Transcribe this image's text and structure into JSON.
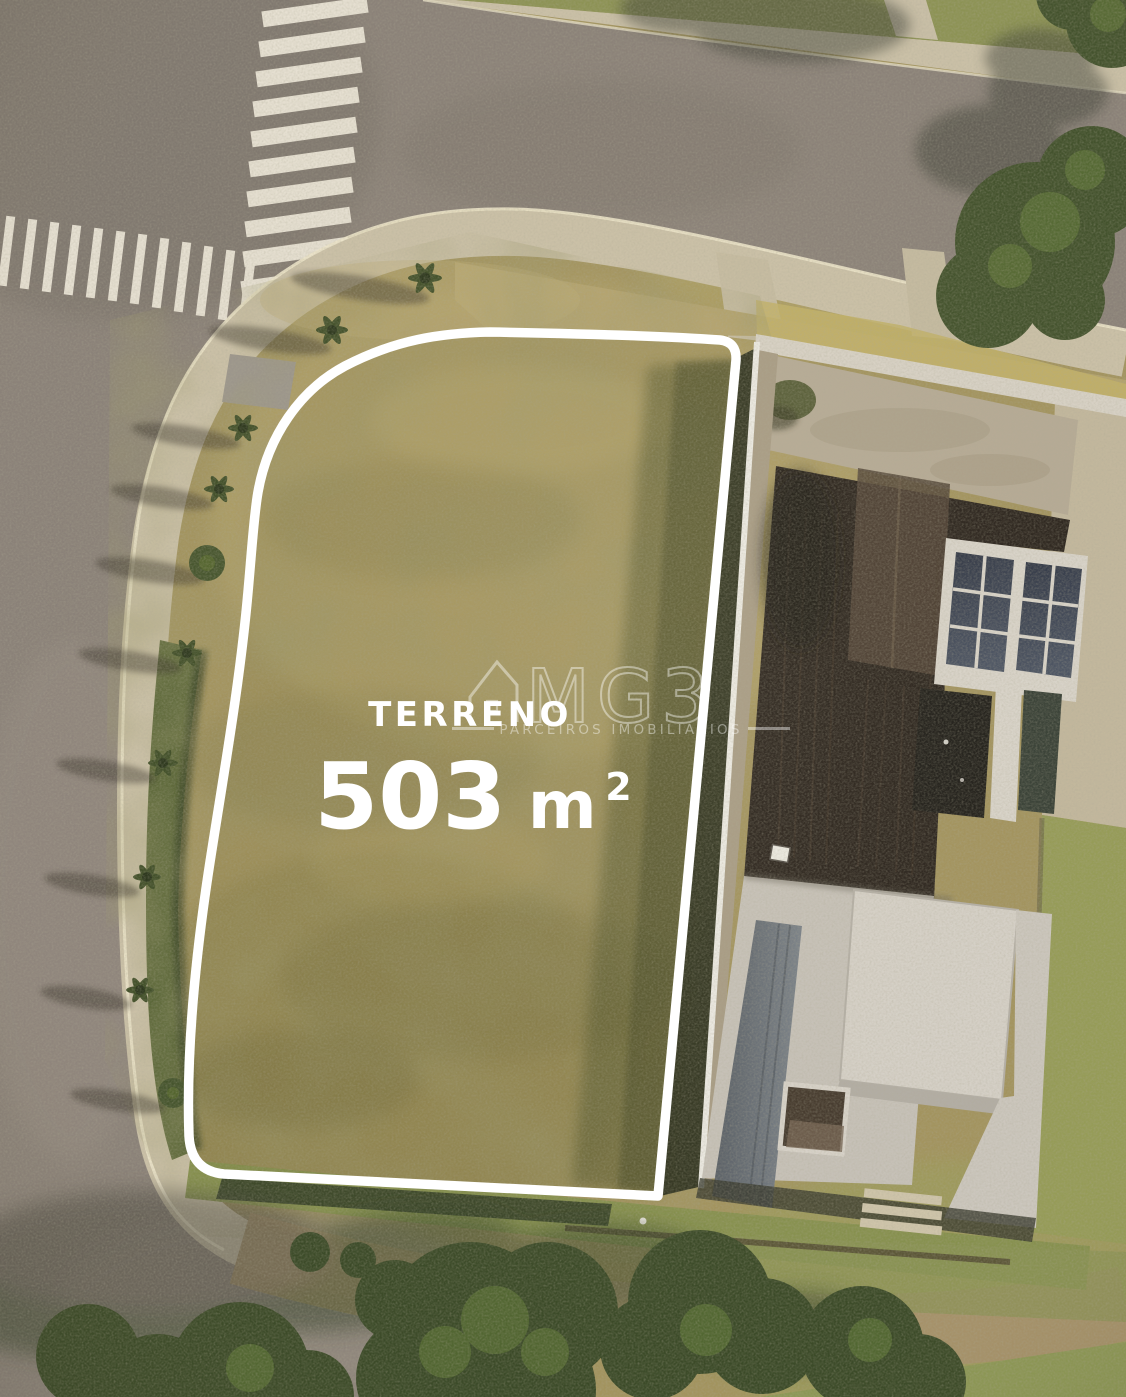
{
  "overlay": {
    "plot_label": "TERRENO",
    "area": {
      "full": "503 m²",
      "number": "503",
      "unit": "m",
      "exponent": "2"
    }
  },
  "watermark": {
    "brand": "MG3",
    "tagline": "PARCEIROS IMOBILIÁRIOS",
    "icon": "house-outline-icon"
  },
  "palette": {
    "outline_white": "#ffffff",
    "asphalt": "#8b8279",
    "sidewalk": "#cbc1a8",
    "plot_grass": "#a3945f",
    "hedge_green": "#5c683a",
    "wood_deck": "#2e2720",
    "solar_panel": "#41475a",
    "white_roof": "#ccc7be",
    "tree_green": "#3c4b29"
  }
}
